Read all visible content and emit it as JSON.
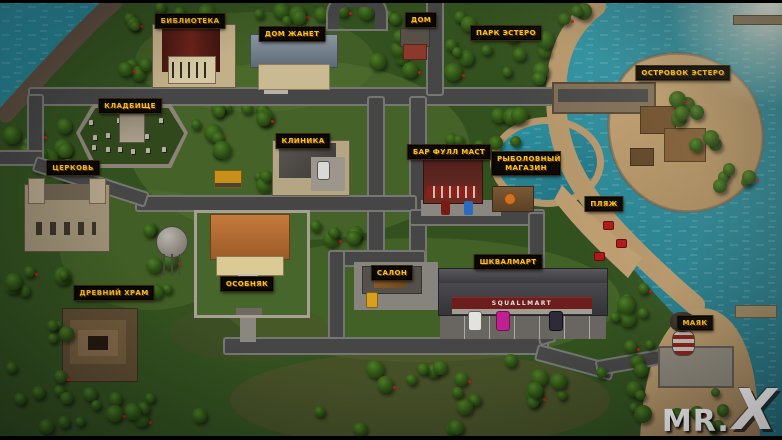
{
  "map": {
    "title": "island-town-location-map",
    "locations": [
      {
        "id": "library",
        "label": "БИБЛИОТЕКА"
      },
      {
        "id": "janet-house",
        "label": "ДОМ ЖАНЕТ"
      },
      {
        "id": "house",
        "label": "ДОМ"
      },
      {
        "id": "park-estero",
        "label": "ПАРК ЭСТЕРО"
      },
      {
        "id": "estero-islet",
        "label": "ОСТРОВОК ЭСТЕРО"
      },
      {
        "id": "cemetery",
        "label": "КЛАДБИЩЕ"
      },
      {
        "id": "clinic",
        "label": "КЛИНИКА"
      },
      {
        "id": "bar-full-mast",
        "label": "БАР ФУЛЛ МАСТ"
      },
      {
        "id": "fishing-shop",
        "label": "РЫБОЛОВНЫЙ МАГАЗИН"
      },
      {
        "id": "church",
        "label": "ЦЕРКОВЬ"
      },
      {
        "id": "beach",
        "label": "ПЛЯЖ"
      },
      {
        "id": "ancient-temple",
        "label": "ДРЕВНИЙ ХРАМ"
      },
      {
        "id": "mansion",
        "label": "ОСОБНЯК"
      },
      {
        "id": "salon",
        "label": "САЛОН"
      },
      {
        "id": "squallmart",
        "label": "ШКВАЛМАРТ"
      },
      {
        "id": "lighthouse",
        "label": "МАЯК"
      }
    ],
    "signs": {
      "squallmart_storefront": "SQUALLMART"
    },
    "logo": {
      "mr": "MR.",
      "x": "X"
    },
    "colors": {
      "label_text": "#f3c41c",
      "label_bg": "#0b0703",
      "water": "#2a8091",
      "jungle": "#33511f",
      "sand": "#b5966b",
      "road": "#464646"
    }
  }
}
